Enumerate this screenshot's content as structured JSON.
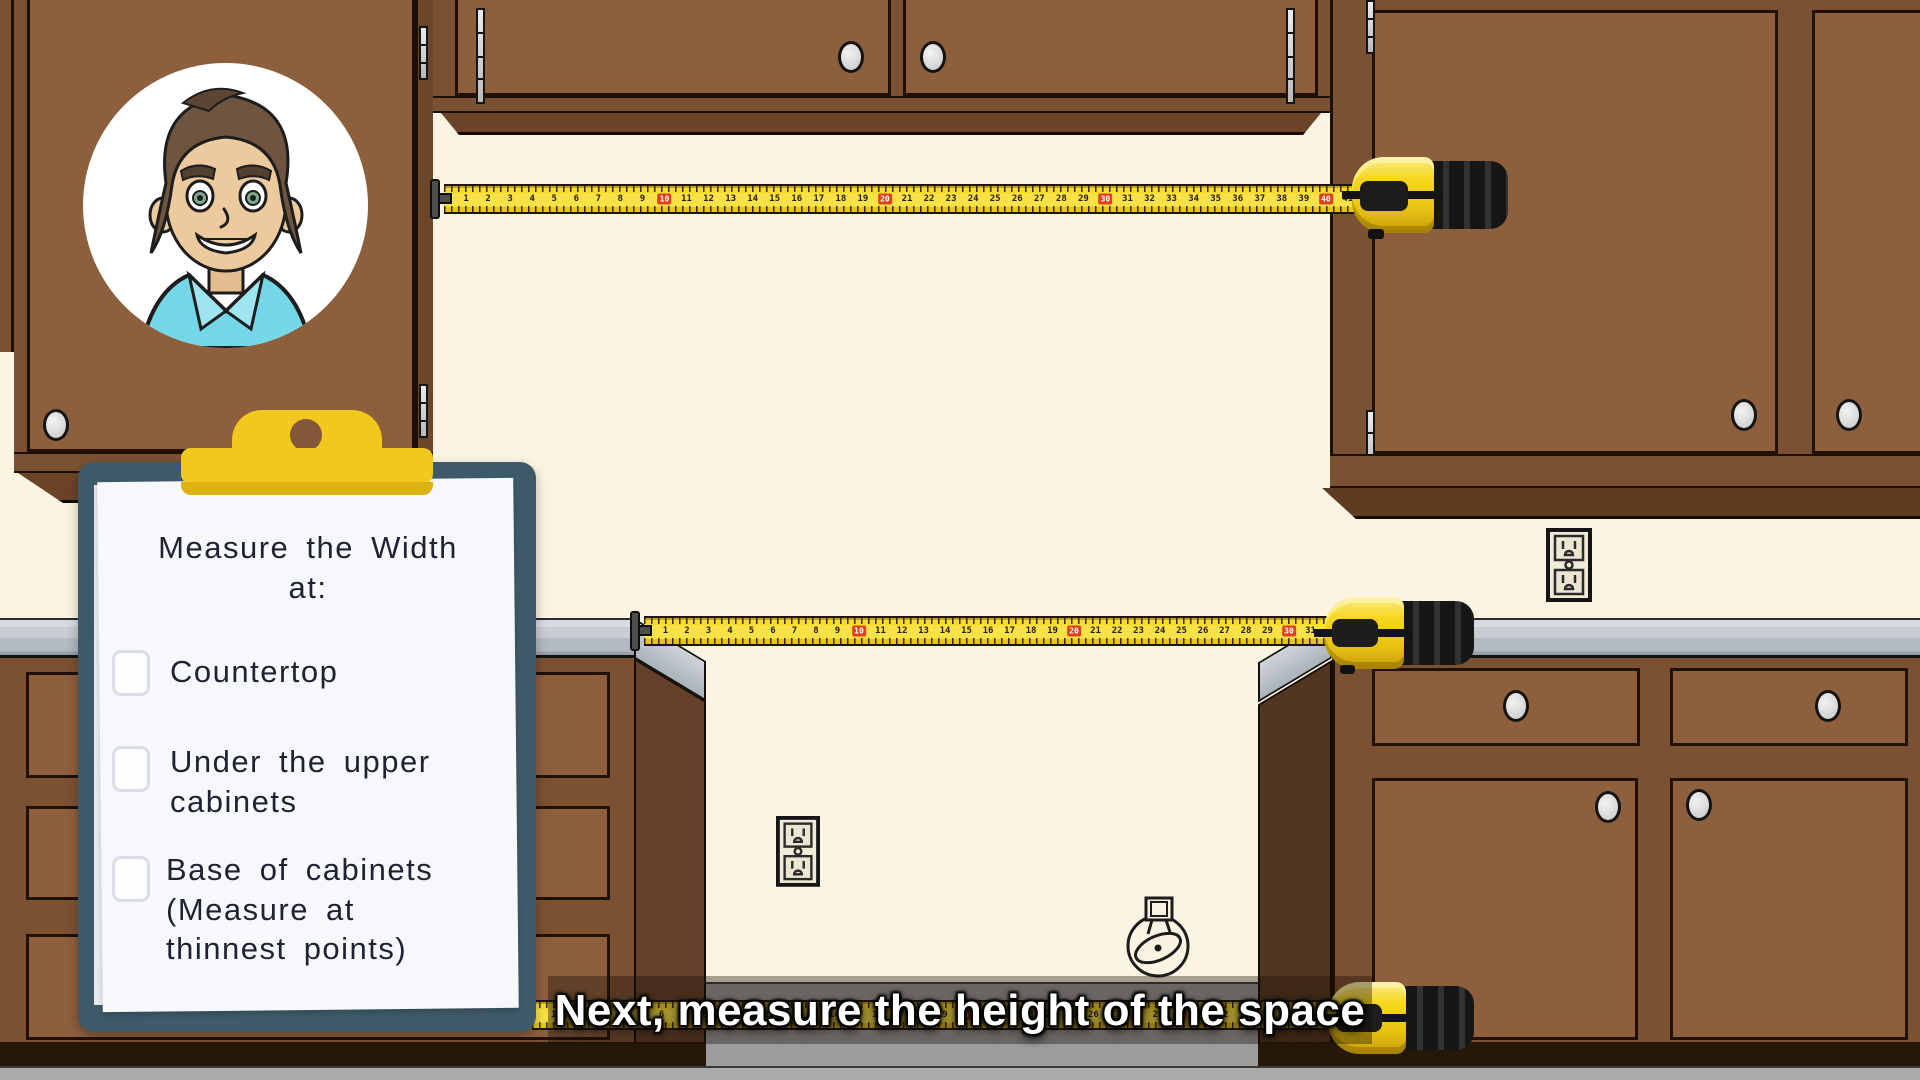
{
  "scene": {
    "caption": {
      "text": "Next, measure the height of the space"
    },
    "clipboard": {
      "heading": "Measure the Width\nat:",
      "items": [
        {
          "label": "Countertop",
          "checked": false
        },
        {
          "label": "Under the upper\ncabinets",
          "checked": false
        },
        {
          "label": "Base of cabinets\n(Measure at\nthinnest points)",
          "checked": false
        }
      ]
    },
    "tapes": [
      {
        "id": "top",
        "numbers_start": 1,
        "numbers_end": 41,
        "red_every": 10
      },
      {
        "id": "middle",
        "numbers_start": 1,
        "numbers_end": 31,
        "red_every": 10
      },
      {
        "id": "bottom",
        "numbers_start": 1,
        "numbers_end": 38,
        "red_every": 10
      }
    ],
    "icons": {
      "outlets": [
        "power-outlet",
        "power-outlet"
      ],
      "gas_valve": "gas-valve-icon"
    },
    "colors": {
      "wall": "#fbf4e2",
      "cabinet_face": "#8d5f3d",
      "cabinet_frame": "#7b5133",
      "counter": "#c7cdd3",
      "tape_yellow": "#f9e247",
      "tape_red": "#e2401d",
      "clipboard_board": "#3e5a68",
      "clip_yellow": "#f2c81e",
      "paper": "#f6f8fb",
      "floor": "#ababab"
    }
  }
}
